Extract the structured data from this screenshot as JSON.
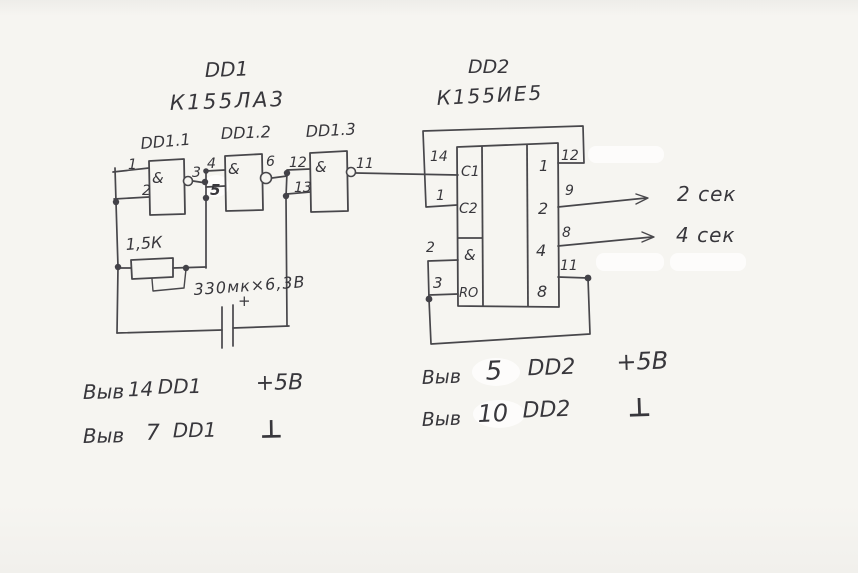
{
  "dd1": {
    "ref": "DD1",
    "part": "К155ЛА3",
    "gates": [
      {
        "label": "DD1.1",
        "func": "&",
        "in1": "1",
        "in2": "2",
        "out": "3"
      },
      {
        "label": "DD1.2",
        "func": "&",
        "in1": "4",
        "in2": "5",
        "out": "6"
      },
      {
        "label": "DD1.3",
        "func": "&",
        "in1": "12",
        "in2": "13",
        "out": "11"
      }
    ]
  },
  "dd2": {
    "ref": "DD2",
    "part": "К155ИЕ5",
    "inputs": [
      {
        "pin": "14",
        "label": "C1"
      },
      {
        "pin": "1",
        "label": "C2"
      },
      {
        "pin": "2",
        "label": "&"
      },
      {
        "pin": "3",
        "label": "RO"
      }
    ],
    "outputs": [
      {
        "pin": "12",
        "label": "1"
      },
      {
        "pin": "9",
        "label": "2"
      },
      {
        "pin": "8",
        "label": "4"
      },
      {
        "pin": "11",
        "label": "8"
      }
    ]
  },
  "components": {
    "resistor": "1,5К",
    "capacitor": "330мк×6,3В",
    "capacitor_polarity": "+"
  },
  "outputs": [
    {
      "label": "2 сек"
    },
    {
      "label": "4 сек"
    }
  ],
  "notes": [
    {
      "prefix": "Выв",
      "pin": "14",
      "chip": "DD1",
      "value": "+5В"
    },
    {
      "prefix": "Выв",
      "pin": "7",
      "chip": "DD1",
      "value": "⊥"
    },
    {
      "prefix": "Выв",
      "pin": "5",
      "chip": "DD2",
      "value": "+5В"
    },
    {
      "prefix": "Выв",
      "pin": "10",
      "chip": "DD2",
      "value": "⊥"
    }
  ],
  "colors": {
    "ink": "#48474b",
    "paper": "#f6f5f1"
  }
}
